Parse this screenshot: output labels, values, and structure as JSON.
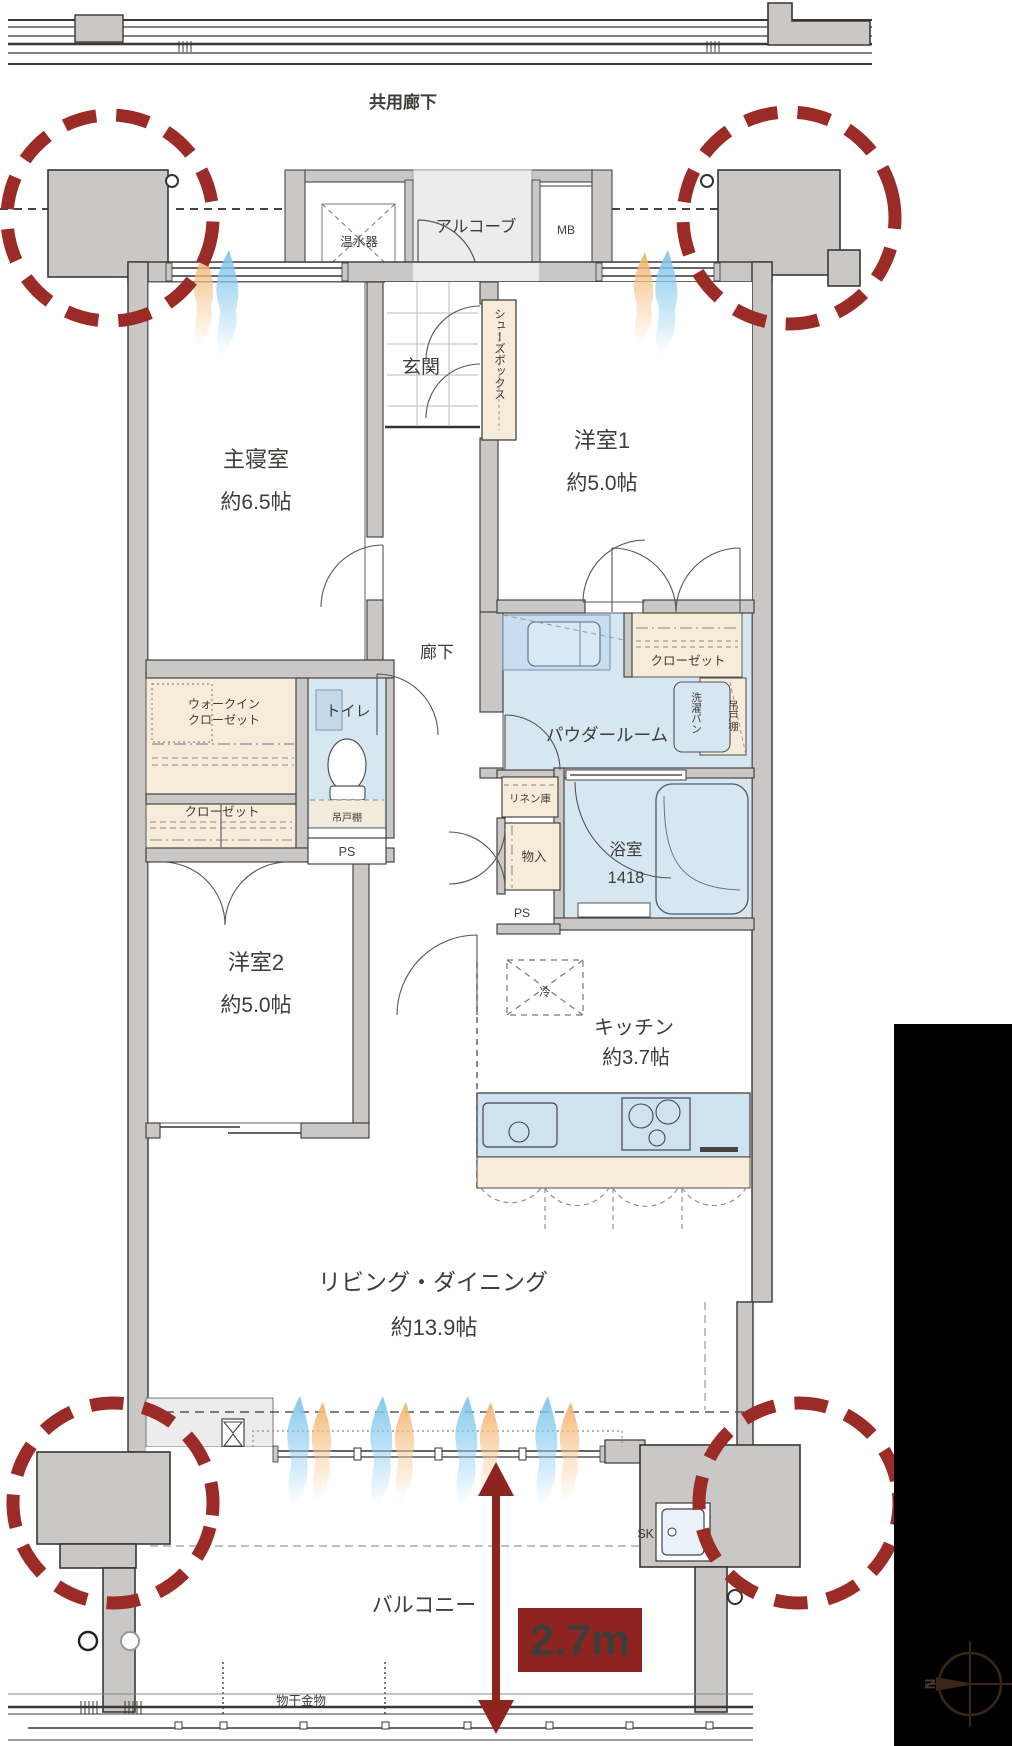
{
  "plan": {
    "common_corridor": "共用廊下",
    "rooms": {
      "master_bedroom": {
        "name": "主寝室",
        "size": "約6.5帖"
      },
      "western_room_1": {
        "name": "洋室1",
        "size": "約5.0帖"
      },
      "western_room_2": {
        "name": "洋室2",
        "size": "約5.0帖"
      },
      "living_dining": {
        "name": "リビング・ダイニング",
        "size": "約13.9帖"
      },
      "kitchen": {
        "name": "キッチン",
        "size": "約3.7帖"
      },
      "bathroom": {
        "name": "浴室",
        "size": "1418"
      },
      "powder_room": {
        "name": "パウダールーム"
      },
      "toilet": {
        "name": "トイレ"
      },
      "entrance": {
        "name": "玄関"
      },
      "hallway": {
        "name": "廊下"
      },
      "alcove": {
        "name": "アルコーブ"
      },
      "balcony": {
        "name": "バルコニー"
      }
    },
    "fixtures": {
      "water_heater": "温水器",
      "meter_box": "MB",
      "shoes_box": "シューズボックス",
      "walk_in_closet_line1": "ウォークイン",
      "walk_in_closet_line2": "クローゼット",
      "closet": "クローゼット",
      "hanging_cupboard": "吊戸棚",
      "pipe_space": "PS",
      "washer_pan": "洗濯パン",
      "linen_storage": "リネン庫",
      "storage": "物入",
      "refrigerator": "冷",
      "slop_sink": "SK",
      "laundry_hardware": "物干金物"
    },
    "annotations": {
      "balcony_depth": "2.7m",
      "compass_north": "N"
    },
    "colors": {
      "accent_red": "#9a2b27",
      "badge_red": "#8e2420",
      "wet_area_blue": "#d6e7f2",
      "closet_cream": "#f6ecd9",
      "wall_grey": "#c9c8c6",
      "flame_blue": "#7dc3eb",
      "flame_orange": "#f3b069"
    }
  }
}
